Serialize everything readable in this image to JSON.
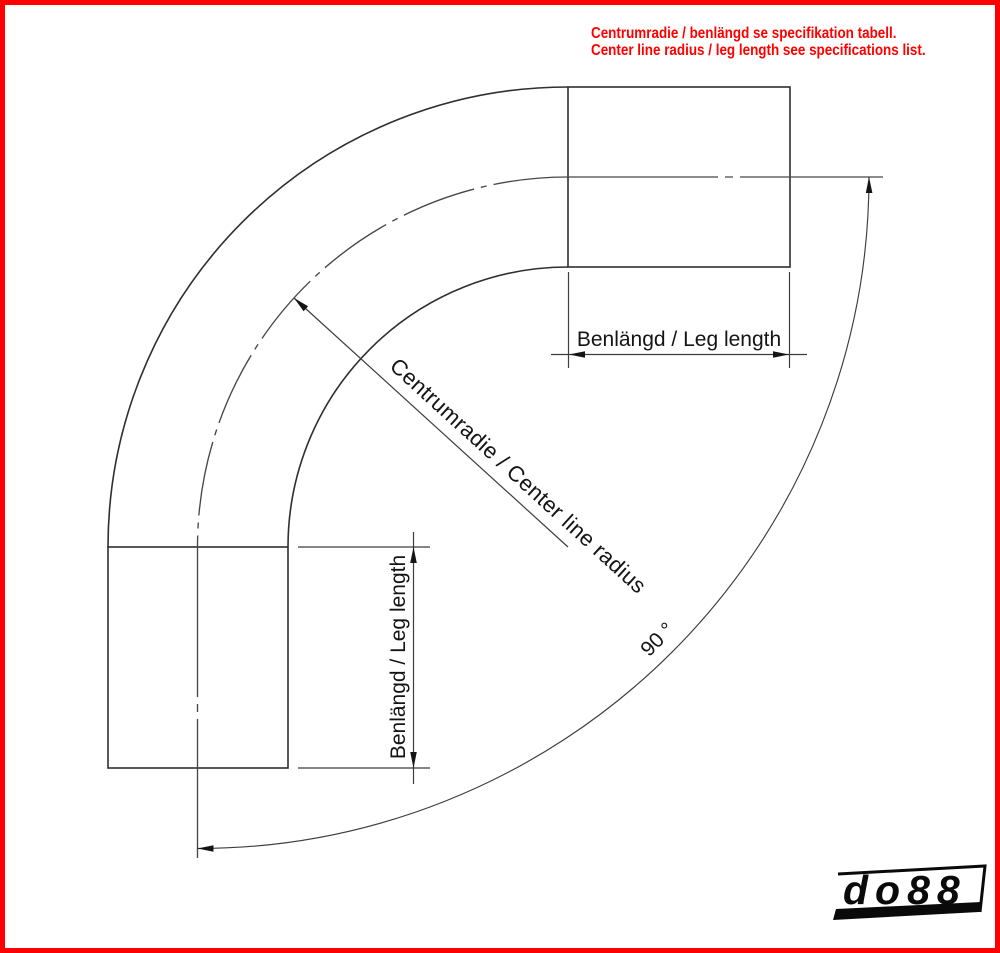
{
  "notice": {
    "line1": "Centrumradie / benlängd se specifikation tabell.",
    "line2": "Center line radius / leg length see specifications list."
  },
  "labels": {
    "leg_length_top": "Benlängd / Leg length",
    "leg_length_left": "Benlängd / Leg length",
    "center_radius": "Centrumradie / Center line radius",
    "angle": "90 °"
  },
  "logo": {
    "text_do": "do",
    "text_88": "88"
  },
  "colors": {
    "accent_red": "#ff0000",
    "line_dark": "#2f2f2f",
    "line_medium": "#474747",
    "line_dim": "#3d3d3d",
    "text_black": "#141414",
    "logo_black": "#0a0a0a",
    "background": "#ffffff"
  }
}
